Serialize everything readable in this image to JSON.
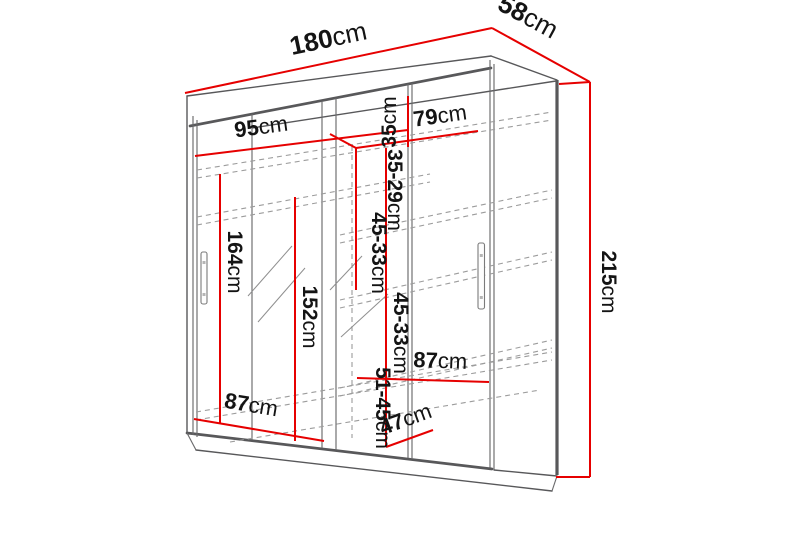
{
  "colors": {
    "accent": "#e60000",
    "line": "#58585a",
    "dash": "#9c9c9c",
    "ink": "#141414",
    "bg": "#ffffff"
  },
  "diagram": {
    "kind": "furniture-dimension-diagram",
    "subject": "sliding-door wardrobe with mirror",
    "unit": "cm"
  },
  "dims": {
    "width": {
      "value": "180",
      "unit": "cm"
    },
    "depth": {
      "value": "58",
      "unit": "cm"
    },
    "height": {
      "value": "215",
      "unit": "cm"
    },
    "section_left_width": {
      "value": "95",
      "unit": "cm"
    },
    "section_right_width": {
      "value": "79",
      "unit": "cm"
    },
    "top_shelf": {
      "value": "35",
      "unit": "cm"
    },
    "shelf_gap_upper": {
      "value": "35-29",
      "unit": "cm"
    },
    "shelf_gap_mid_left": {
      "value": "45-33",
      "unit": "cm"
    },
    "shelf_gap_mid_right": {
      "value": "45-33",
      "unit": "cm"
    },
    "hang_height_left": {
      "value": "164",
      "unit": "cm"
    },
    "hang_height_mid": {
      "value": "152",
      "unit": "cm"
    },
    "bottom_width_left": {
      "value": "87",
      "unit": "cm"
    },
    "shelf_width_right": {
      "value": "87",
      "unit": "cm"
    },
    "bottom_gap": {
      "value": "51-45",
      "unit": "cm"
    },
    "bottom_depth": {
      "value": "47",
      "unit": "cm"
    }
  }
}
